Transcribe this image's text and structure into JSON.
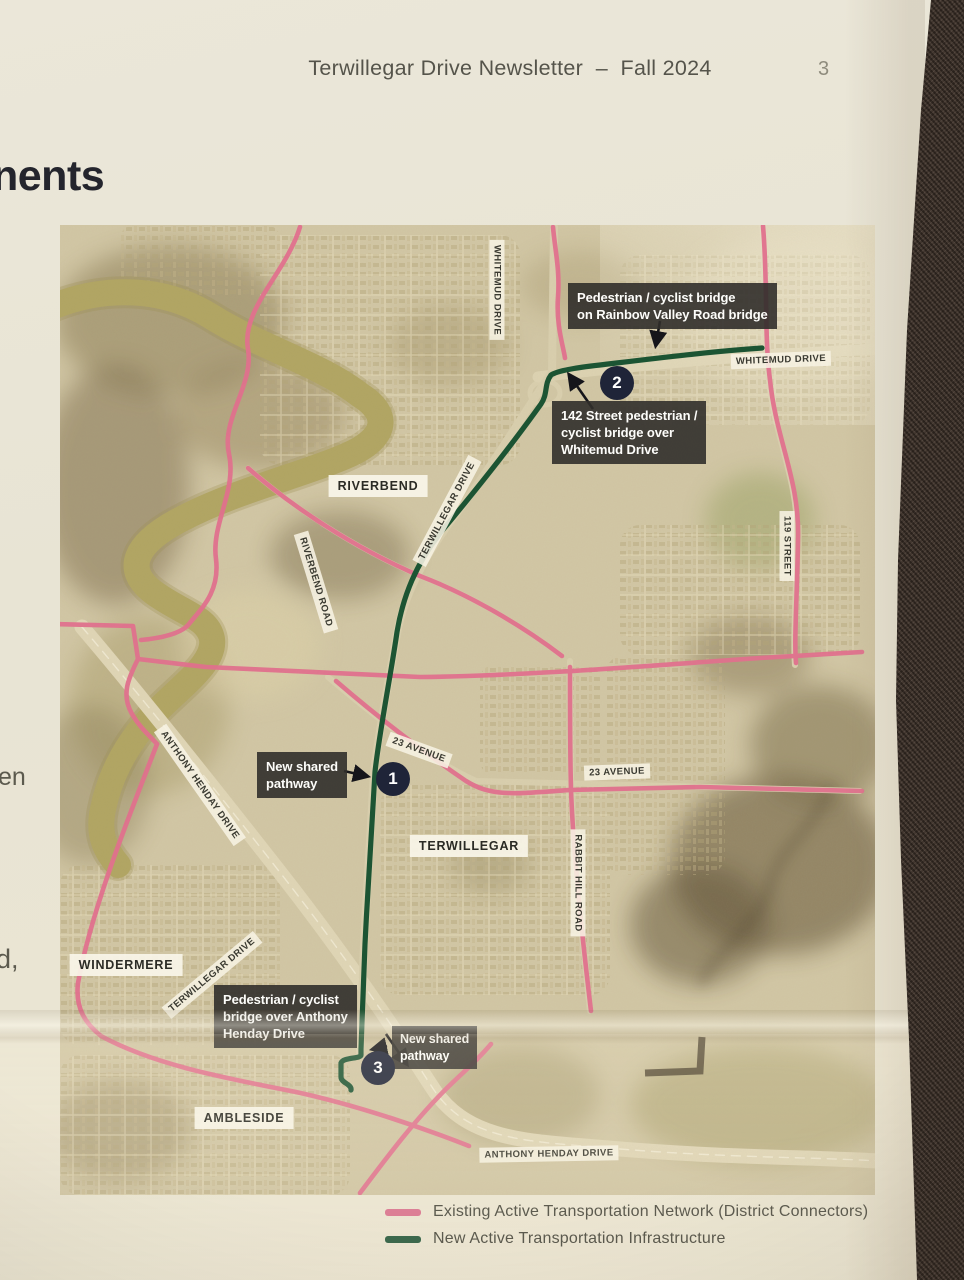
{
  "header": {
    "title": "Terwillegar Drive Newsletter",
    "separator": "–",
    "issue": "Fall 2024",
    "page_number": "3"
  },
  "left_column": {
    "partial_heading": "nents",
    "fragments": [
      "n",
      "en",
      "d,"
    ]
  },
  "map": {
    "neighborhoods": [
      {
        "name": "RIVERBEND"
      },
      {
        "name": "TERWILLEGAR"
      },
      {
        "name": "WINDERMERE"
      },
      {
        "name": "AMBLESIDE"
      }
    ],
    "roads": [
      {
        "name": "WHITEMUD DRIVE"
      },
      {
        "name": "WHITEMUD DRIVE"
      },
      {
        "name": "TERWILLEGAR DRIVE"
      },
      {
        "name": "RIVERBEND ROAD"
      },
      {
        "name": "119 STREET"
      },
      {
        "name": "23 AVENUE"
      },
      {
        "name": "23 AVENUE"
      },
      {
        "name": "RABBIT HILL ROAD"
      },
      {
        "name": "ANTHONY HENDAY DRIVE"
      },
      {
        "name": "TERWILLEGAR DRIVE"
      },
      {
        "name": "ANTHONY HENDAY DRIVE"
      }
    ],
    "markers": [
      {
        "number": "1"
      },
      {
        "number": "2"
      },
      {
        "number": "3"
      }
    ],
    "callouts": [
      {
        "id": "rainbow-valley-bridge",
        "lines": [
          "Pedestrian / cyclist bridge",
          "on Rainbow Valley Road bridge"
        ]
      },
      {
        "id": "142-street-bridge",
        "lines": [
          "142 Street pedestrian /",
          "cyclist bridge over",
          "Whitemud Drive"
        ]
      },
      {
        "id": "new-shared-pathway-1",
        "lines": [
          "New shared",
          "pathway"
        ]
      },
      {
        "id": "henday-bridge",
        "lines": [
          "Pedestrian / cyclist",
          "bridge over Anthony",
          "Henday Drive"
        ]
      },
      {
        "id": "new-shared-pathway-3",
        "lines": [
          "New shared",
          "pathway"
        ]
      }
    ]
  },
  "legend": {
    "items": [
      {
        "label": "Existing Active Transportation Network (District Connectors)",
        "color": "#d9738e"
      },
      {
        "label": "New Active Transportation Infrastructure",
        "color": "#2a5c40"
      }
    ]
  },
  "colors": {
    "route_existing": "#e0718d",
    "route_new": "#1c5433",
    "callout_bg": "#312f2b",
    "marker_bg": "#1f2438",
    "map_base": "#cfc4a1",
    "page_bg": "#e9e5d6",
    "fabric_bg": "#41342b"
  }
}
